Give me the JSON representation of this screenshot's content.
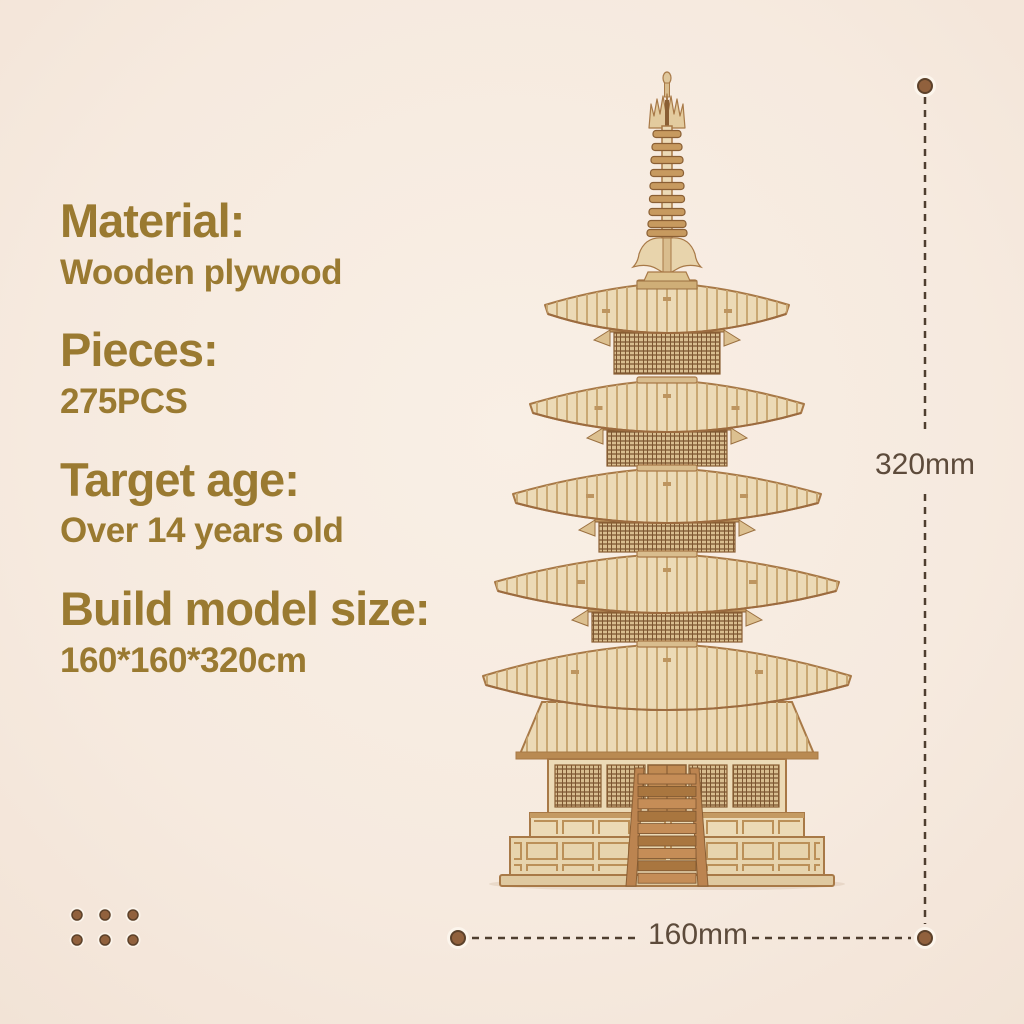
{
  "page": {
    "background_color": "#f6eadf",
    "accent_color": "#9a7a31",
    "dimension_text_color": "#5d4b3b",
    "dimension_line_color": "#4f3e2f",
    "wood_color": "#ecdab6",
    "dot_color": "#8e5f3c"
  },
  "specs": [
    {
      "heading": "Material:",
      "value": "Wooden plywood"
    },
    {
      "heading": "Pieces:",
      "value": "275PCS"
    },
    {
      "heading": "Target age:",
      "value": "Over 14 years old"
    },
    {
      "heading": "Build model size:",
      "value": "160*160*320cm"
    }
  ],
  "dimensions": {
    "height_label": "320mm",
    "width_label": "160mm"
  },
  "illustration": {
    "name": "wooden-pagoda-model"
  }
}
